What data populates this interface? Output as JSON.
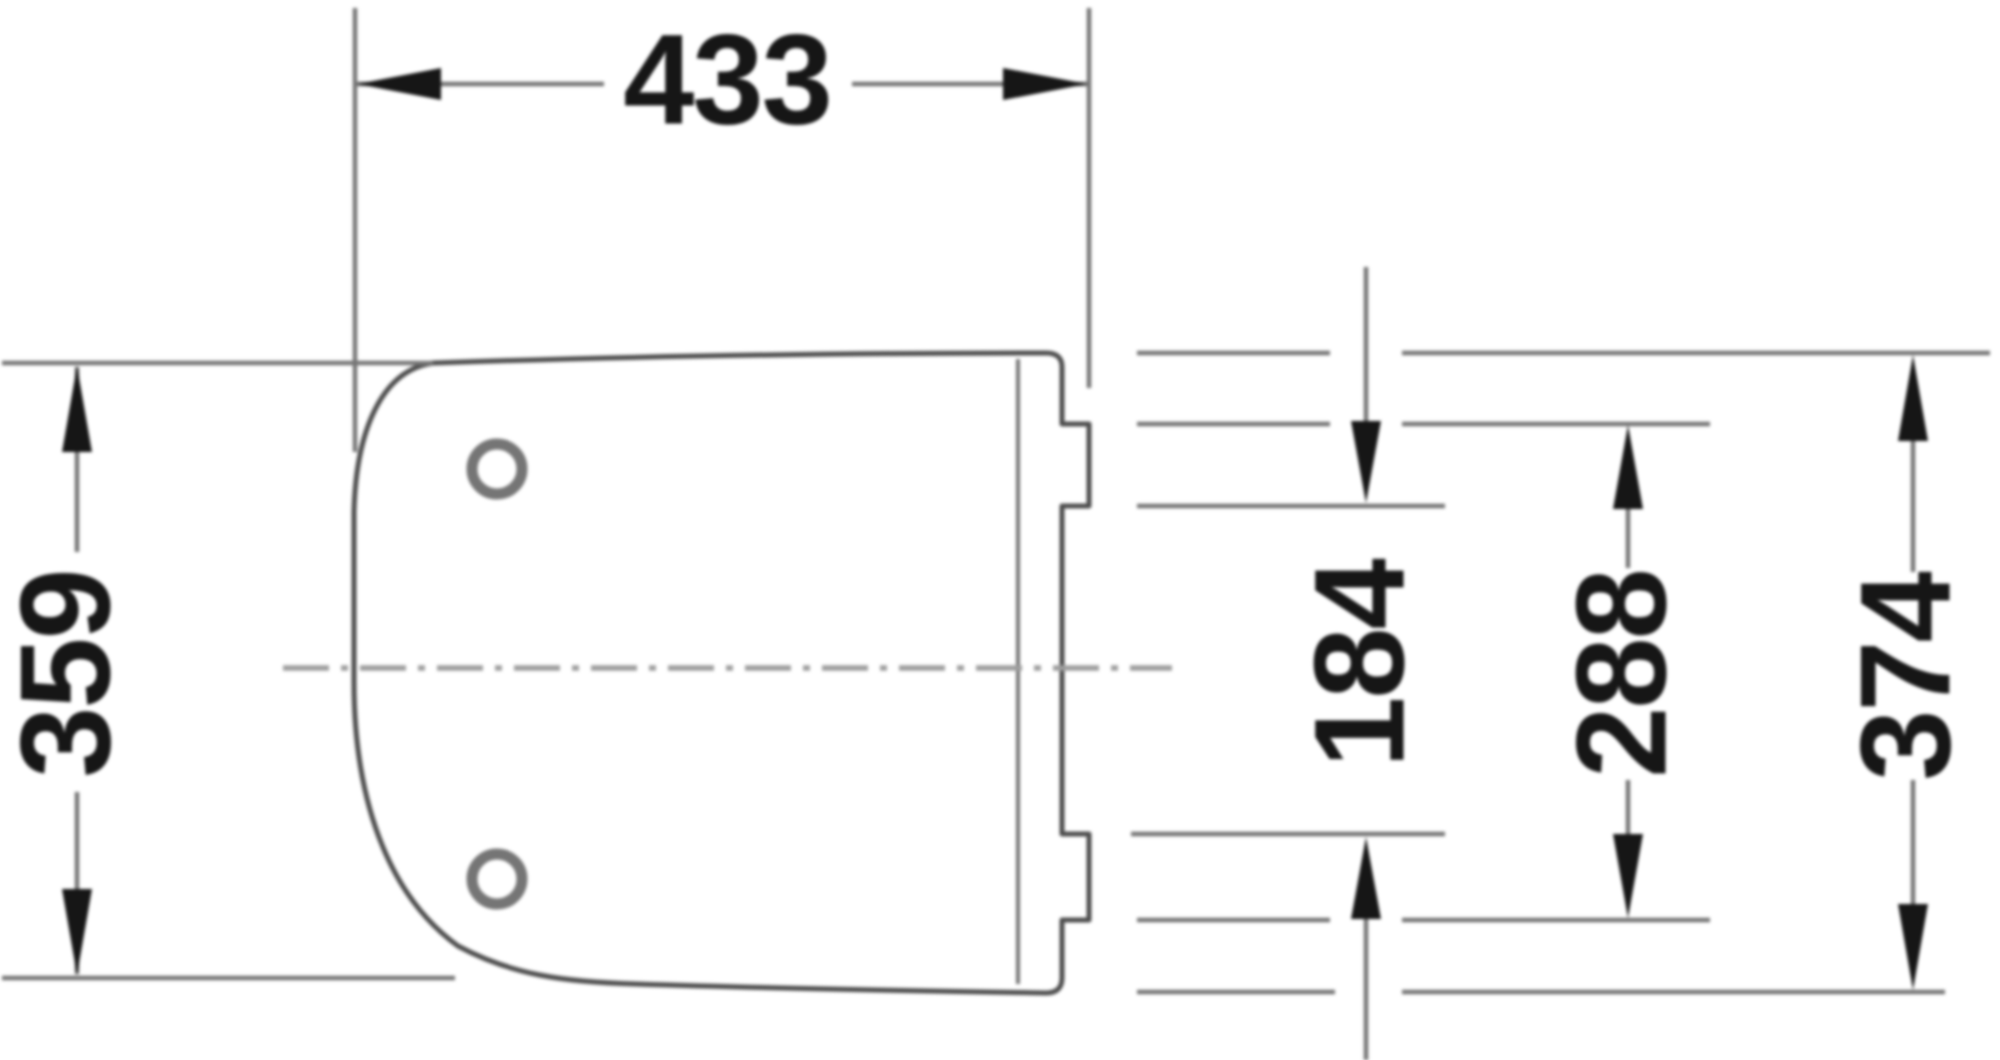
{
  "page": {
    "background": "#ffffff"
  },
  "drawing": {
    "colors": {
      "page_bg": "#ffffff",
      "outline": "#4d4d4d",
      "thin_line": "#757575",
      "center_line": "#9e9e9e",
      "accent": "#161616"
    },
    "dimensions": {
      "overall_width": {
        "value": "433",
        "orientation": "horizontal",
        "position": "top"
      },
      "front_height": {
        "value": "359",
        "orientation": "vertical",
        "position": "left"
      },
      "hinge_inner_span": {
        "value": "184",
        "orientation": "vertical",
        "position": "right-inner"
      },
      "hinge_plate_span": {
        "value": "288",
        "orientation": "vertical",
        "position": "right-middle"
      },
      "overall_height": {
        "value": "374",
        "orientation": "vertical",
        "position": "right-outer"
      }
    }
  }
}
